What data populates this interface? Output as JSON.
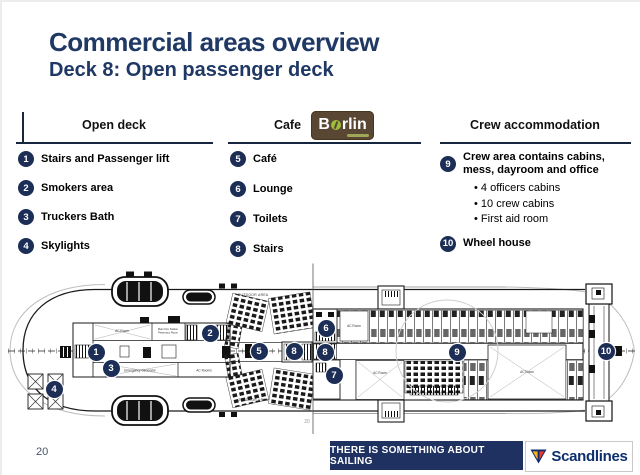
{
  "slide": {
    "title": "Commercial areas overview",
    "subtitle": "Deck 8: Open passenger deck",
    "page_number": "20"
  },
  "columns": [
    {
      "header": "Open deck",
      "items": [
        {
          "num": "1",
          "label": "Stairs and Passenger lift"
        },
        {
          "num": "2",
          "label": "Smokers area"
        },
        {
          "num": "3",
          "label": "Truckers Bath"
        },
        {
          "num": "4",
          "label": "Skylights"
        }
      ]
    },
    {
      "header": "Cafe",
      "logo": {
        "prefix": "B",
        "suffix": "rlin"
      },
      "items": [
        {
          "num": "5",
          "label": "Café"
        },
        {
          "num": "6",
          "label": "Lounge"
        },
        {
          "num": "7",
          "label": "Toilets"
        },
        {
          "num": "8",
          "label": "Stairs"
        }
      ]
    },
    {
      "header": "Crew accommodation",
      "items": [
        {
          "num": "9",
          "label": "Crew area contains cabins, mess, dayroom and office",
          "bullets": [
            "4 officers cabins",
            "10 crew cabins",
            "First aid room"
          ]
        },
        {
          "num": "10",
          "label": "Wheel house"
        }
      ]
    }
  ],
  "plan": {
    "labels": {
      "outdoor_top": "OUTDOOR AREA",
      "outdoor_bottom": "OUTDOOR AREA",
      "ac_room_aft": "AC Room",
      "fire_station_1": "Main Fire Station",
      "fire_station_2": "Pharmacy Room",
      "emergency_generator": "Emergency Generator",
      "ac_rooms": "AC Rooms",
      "ac_room_cafe": "AC Room",
      "ac_room_mid": "AC Room",
      "ac_room_crew": "AC Room",
      "frame_note": "20"
    },
    "markers": [
      {
        "n": "1",
        "x": 96,
        "y": 352
      },
      {
        "n": "2",
        "x": 210,
        "y": 333
      },
      {
        "n": "3",
        "x": 111,
        "y": 368
      },
      {
        "n": "4",
        "x": 54,
        "y": 389
      },
      {
        "n": "5",
        "x": 259,
        "y": 351
      },
      {
        "n": "8",
        "x": 294,
        "y": 351
      },
      {
        "n": "6",
        "x": 326,
        "y": 328
      },
      {
        "n": "8",
        "x": 325,
        "y": 352
      },
      {
        "n": "7",
        "x": 334,
        "y": 375
      },
      {
        "n": "9",
        "x": 457,
        "y": 352
      },
      {
        "n": "10",
        "x": 606,
        "y": 351
      }
    ]
  },
  "footer": {
    "tagline": "THERE IS SOMETHING ABOUT SAILING",
    "brand": "Scandlines"
  },
  "colors": {
    "navy": "#1F3864",
    "marker_navy": "#1d2e56",
    "footer_navy": "#1e3160",
    "brand_navy": "#0e2f6e",
    "logo_brown": "#5a4733",
    "bean_green": "#9cbe3a",
    "pennant_yellow": "#f5b31d",
    "pennant_red": "#e23a2e"
  }
}
